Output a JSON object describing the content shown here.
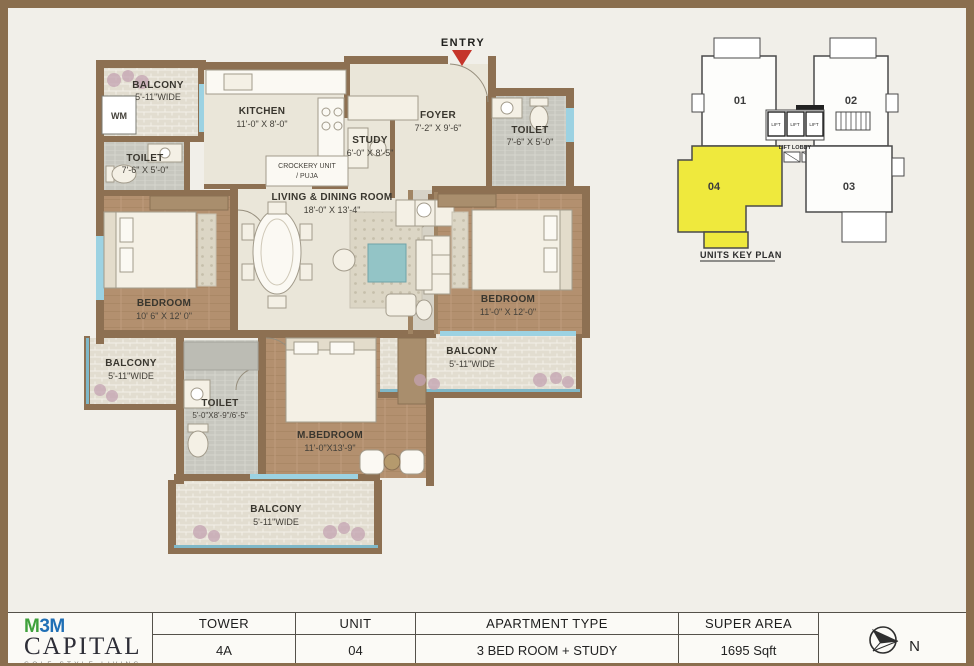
{
  "plan": {
    "entry": "ENTRY",
    "rooms": {
      "balcony_tl": {
        "name": "BALCONY",
        "dims": "5'-11\"WIDE"
      },
      "wm": {
        "name": "WM"
      },
      "kitchen": {
        "name": "KITCHEN",
        "dims": "11'-0\" X 8'-0\""
      },
      "crockery": {
        "name": "CROCKERY UNIT",
        "dims": "/ PUJA"
      },
      "study": {
        "name": "STUDY",
        "dims": "6'-0\" X 8'-5\""
      },
      "foyer": {
        "name": "FOYER",
        "dims": "7'-2\" X 9'-6\""
      },
      "toilet_tr": {
        "name": "TOILET",
        "dims": "7'-6\" X 5'-0\""
      },
      "toilet_tl": {
        "name": "TOILET",
        "dims": "7'-6\" X 5'-0\""
      },
      "living": {
        "name": "LIVING & DINING ROOM",
        "dims": "18'-0\" X 13'-4\""
      },
      "bedroom_l": {
        "name": "BEDROOM",
        "dims": "10' 6\" X 12' 0\""
      },
      "bedroom_r": {
        "name": "BEDROOM",
        "dims": "11'-0\" X 12'-0\""
      },
      "balcony_ml": {
        "name": "BALCONY",
        "dims": "5'-11\"WIDE"
      },
      "toilet_b": {
        "name": "TOILET",
        "dims": "5'-0\"X8'-9\"/6'-5\""
      },
      "mbedroom": {
        "name": "M.BEDROOM",
        "dims": "11'-0\"X13'-9\""
      },
      "balcony_r": {
        "name": "BALCONY",
        "dims": "5'-11\"WIDE"
      },
      "balcony_b": {
        "name": "BALCONY",
        "dims": "5'-11\"WIDE"
      }
    }
  },
  "key_plan": {
    "title": "UNITS KEY PLAN",
    "unit_01": "01",
    "unit_02": "02",
    "unit_03": "03",
    "unit_04": "04",
    "highlighted_unit": "04",
    "highlight_color": "#efe93d",
    "lift": "LIFT",
    "lift_lobby": "LIFT LOBBY"
  },
  "info_table": {
    "headers": {
      "tower": "TOWER",
      "unit": "UNIT",
      "apartment_type": "APARTMENT TYPE",
      "super_area": "SUPER AREA"
    },
    "values": {
      "tower": "4A",
      "unit": "04",
      "apartment_type": "3 BED ROOM + STUDY",
      "super_area": "1695 Sqft"
    },
    "compass": "N"
  },
  "logo": {
    "brand_m1": "M",
    "brand_3": "3",
    "brand_m2": "M",
    "name": "CAPITAL",
    "tagline": "GOLF STYLE LIVING"
  },
  "colors": {
    "wall": "#8d7052",
    "entry_arrow": "#c5352b",
    "window": "#9cd2e2",
    "unit_highlight": "#efe93d"
  }
}
